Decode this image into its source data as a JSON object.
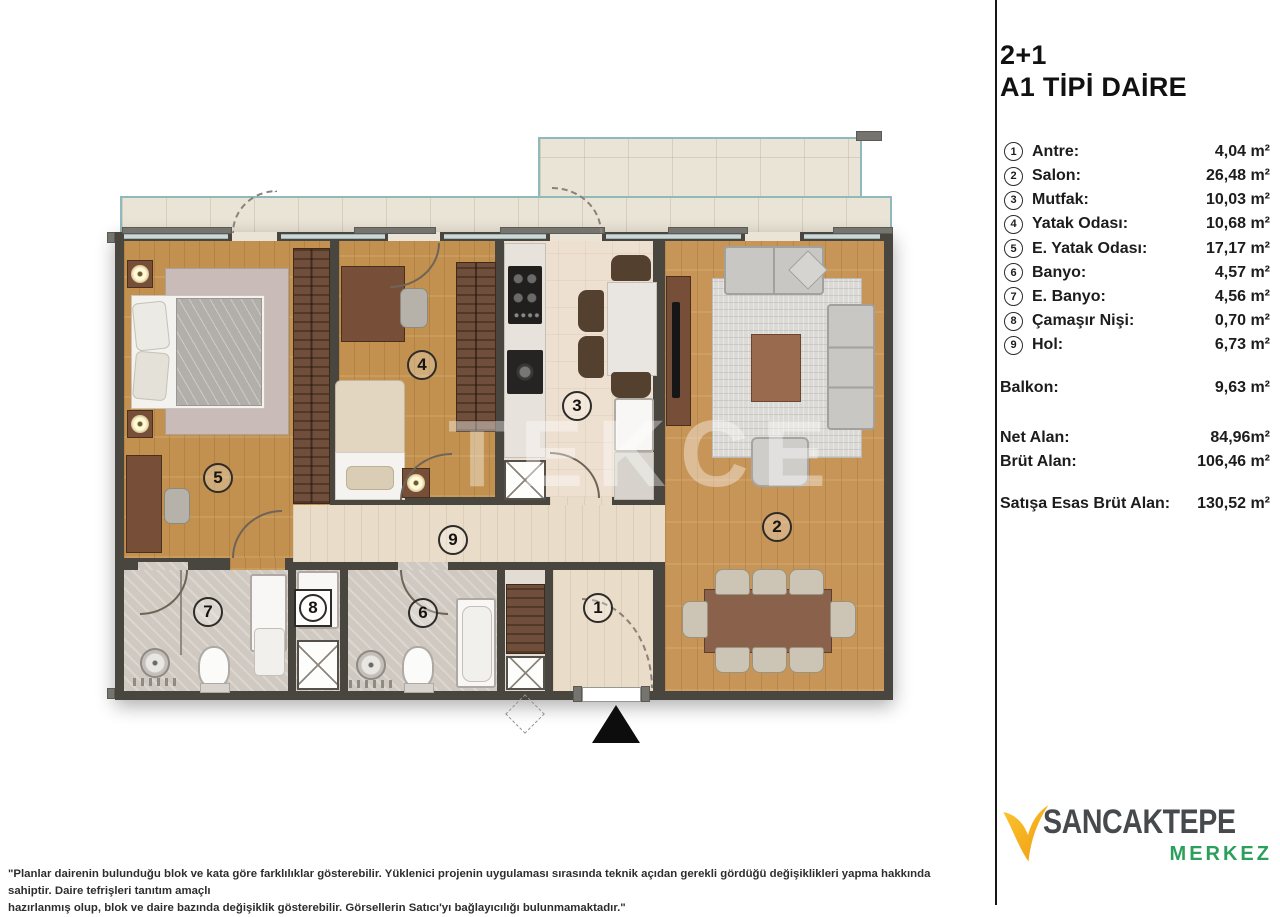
{
  "panel": {
    "title_line1": "2+1",
    "title_line2": "A1 TİPİ DAİRE",
    "rooms": [
      {
        "num": "1",
        "label": "Antre:",
        "area": "4,04 m²"
      },
      {
        "num": "2",
        "label": "Salon:",
        "area": "26,48 m²"
      },
      {
        "num": "3",
        "label": "Mutfak:",
        "area": "10,03 m²"
      },
      {
        "num": "4",
        "label": "Yatak Odası:",
        "area": "10,68 m²"
      },
      {
        "num": "5",
        "label": "E. Yatak Odası:",
        "area": "17,17 m²"
      },
      {
        "num": "6",
        "label": "Banyo:",
        "area": "4,57 m²"
      },
      {
        "num": "7",
        "label": "E. Banyo:",
        "area": "4,56 m²"
      },
      {
        "num": "8",
        "label": "Çamaşır Nişi:",
        "area": "0,70 m²"
      },
      {
        "num": "9",
        "label": "Hol:",
        "area": "6,73 m²"
      }
    ],
    "balkon": {
      "label": "Balkon:",
      "area": "9,63 m²"
    },
    "totals": [
      {
        "label": "Net Alan:",
        "area": "84,96m²"
      },
      {
        "label": "Brüt Alan:",
        "area": "106,46 m²"
      }
    ],
    "sales": {
      "label": "Satışa Esas Brüt Alan:",
      "area": "130,52 m²"
    }
  },
  "plan": {
    "watermark": "TEKCE",
    "markers": [
      {
        "num": "1",
        "room": "antre"
      },
      {
        "num": "2",
        "room": "salon"
      },
      {
        "num": "3",
        "room": "mutfak"
      },
      {
        "num": "4",
        "room": "yatak-odasi"
      },
      {
        "num": "5",
        "room": "e-yatak-odasi"
      },
      {
        "num": "6",
        "room": "banyo"
      },
      {
        "num": "7",
        "room": "e-banyo"
      },
      {
        "num": "8",
        "room": "camasir-nisi"
      },
      {
        "num": "9",
        "room": "hol"
      }
    ]
  },
  "logo": {
    "name": "SANCAKTEPE",
    "sub": "MERKEZ"
  },
  "footer": {
    "disclaimer": "\"Planlar dairenin bulunduğu blok ve kata göre farklılıklar gösterebilir. Yüklenici projenin uygulaması sırasında teknik açıdan gerekli gördüğü değişiklikleri yapma hakkında sahiptir. Daire tefrişleri tanıtım amaçlı\nhazırlanmış olup, blok ve daire bazında değişiklik gösterebilir. Görsellerin Satıcı'yı bağlayıcılığı bulunmamaktadır.\""
  },
  "colors": {
    "wall": "#49453f",
    "wood_floor": "#c2914f",
    "tile_floor": "#e9dcc9",
    "bath_floor": "#d0c9c1",
    "balcony_rail": "#8fb9ba",
    "logo_accent": "#f5a81c",
    "logo_green": "#2ba05c"
  }
}
